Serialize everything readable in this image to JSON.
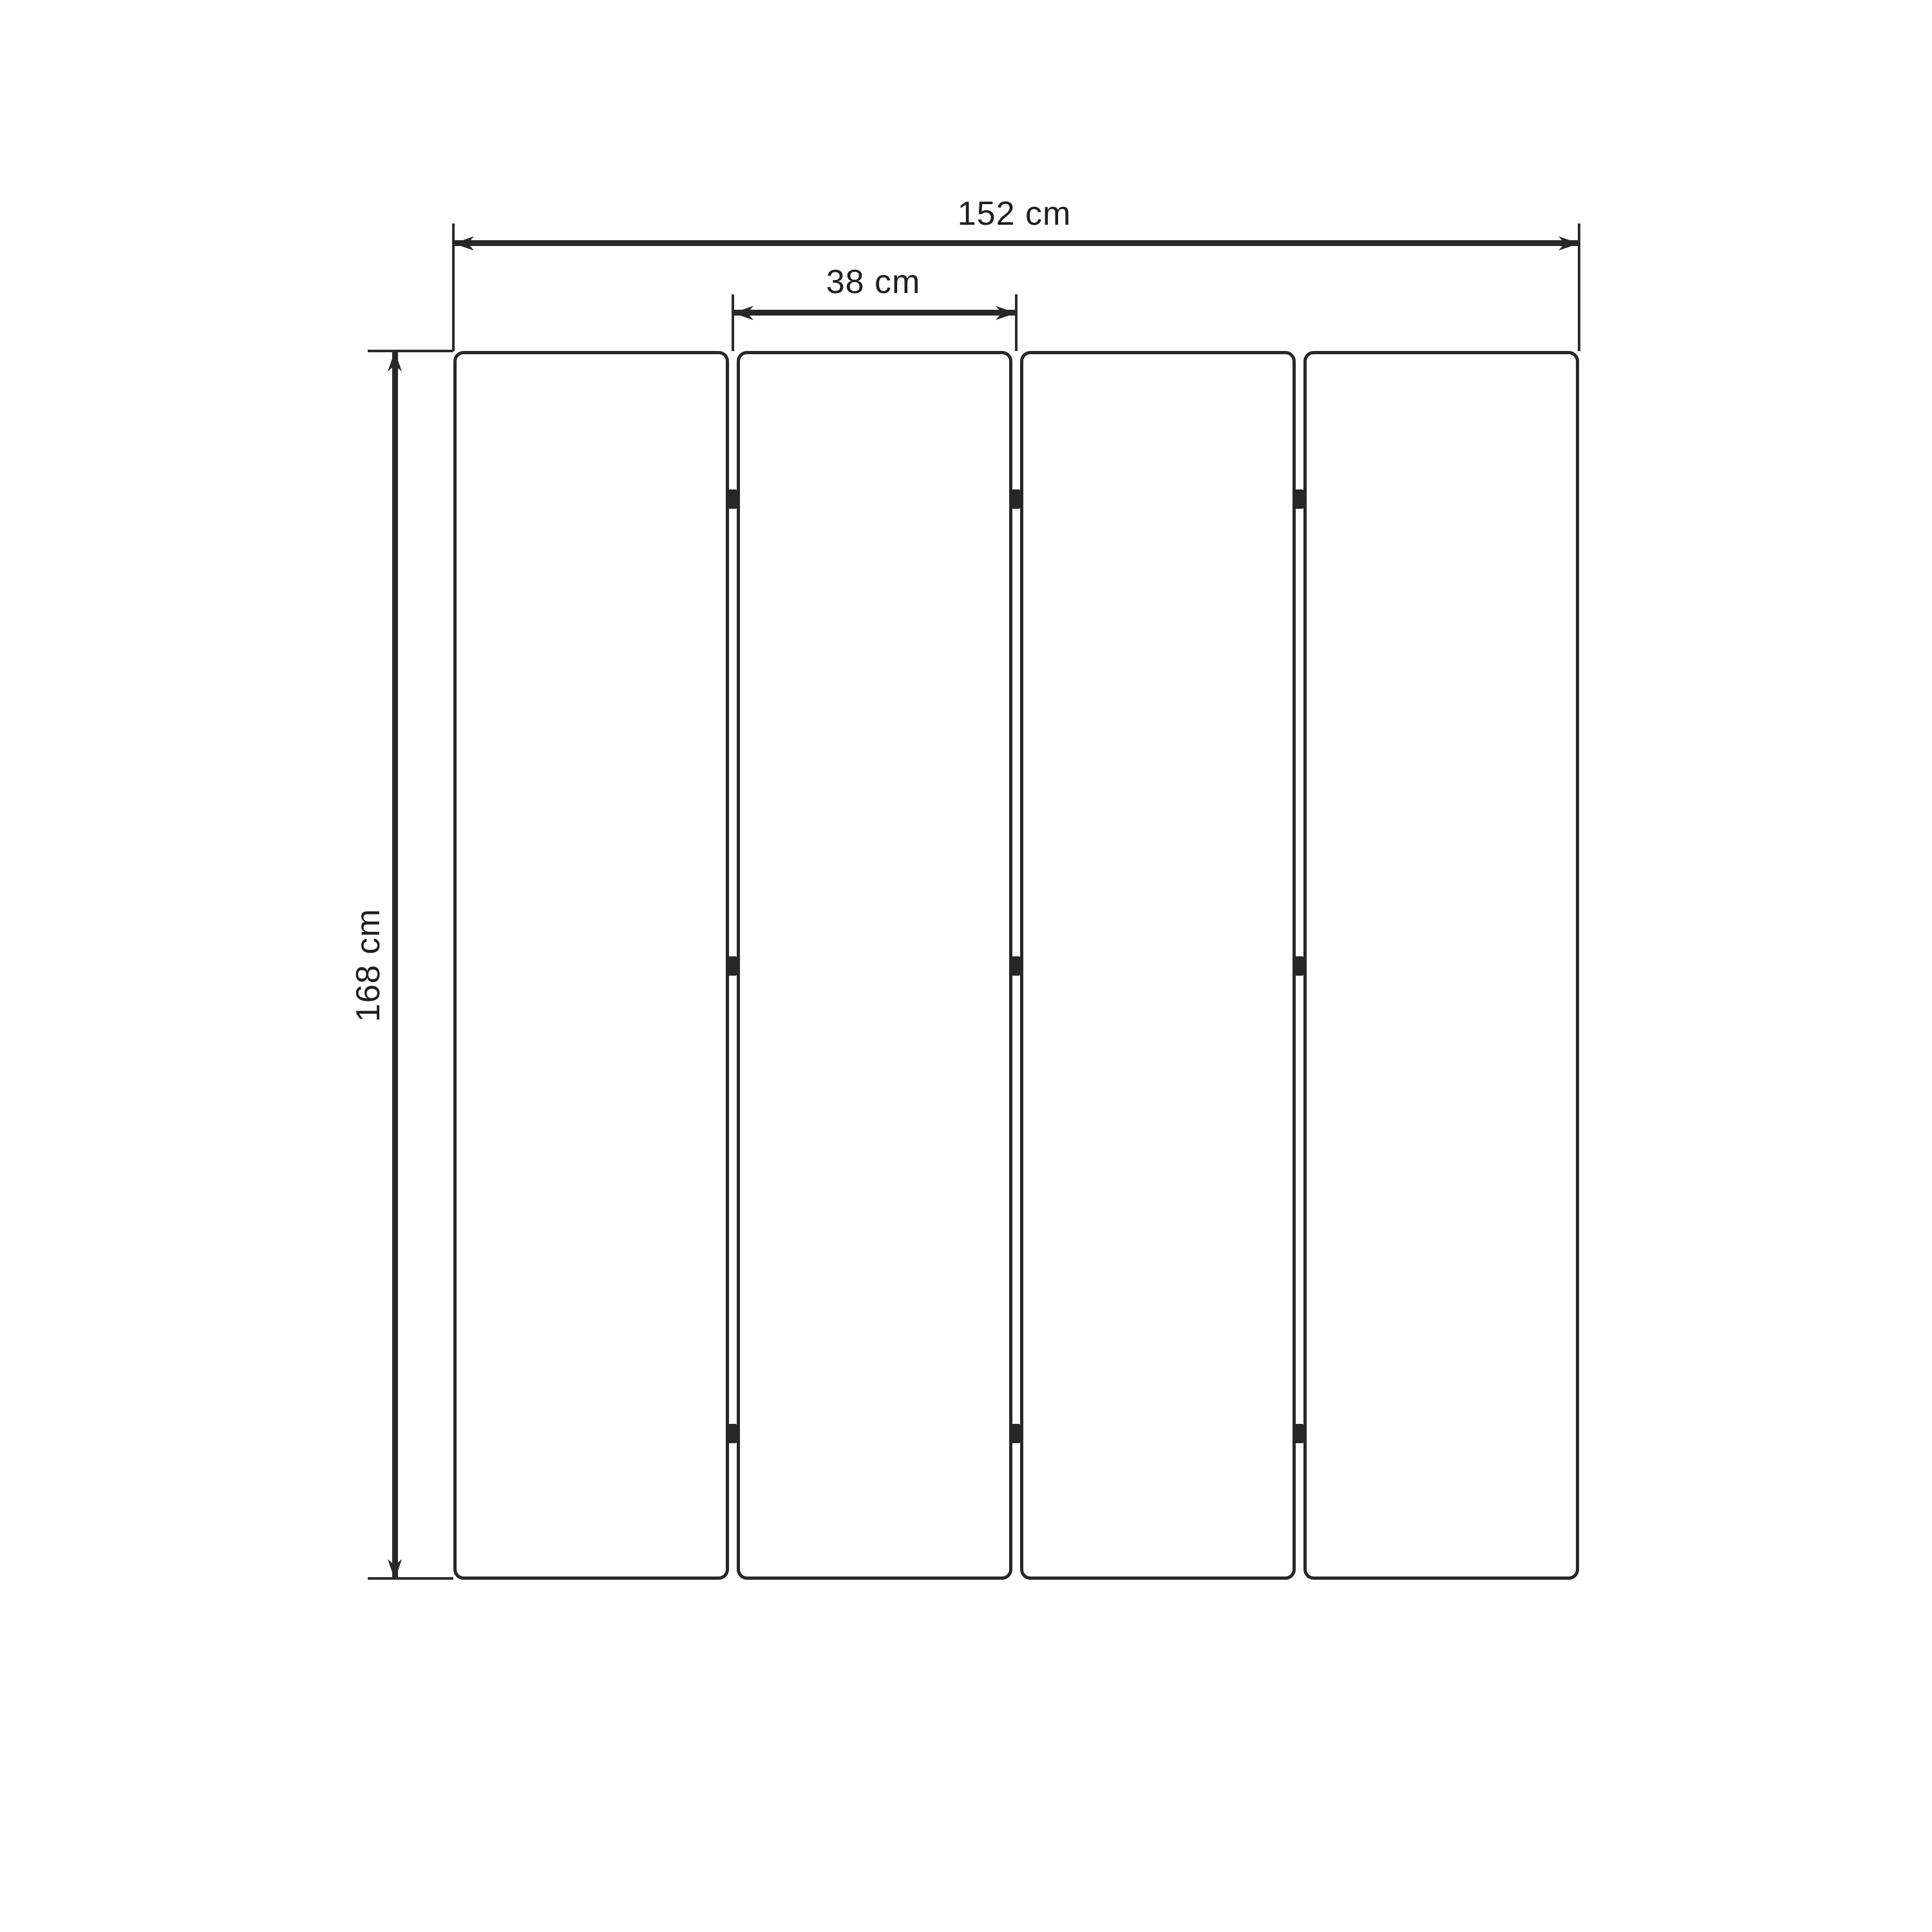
{
  "diagram": {
    "labels": {
      "total_width": "152 cm",
      "panel_width": "38 cm",
      "height": "168 cm"
    },
    "values": {
      "total_width_cm": 152,
      "panel_width_cm": 38,
      "height_cm": 168,
      "unit": "cm"
    },
    "panel_count": 4,
    "hinge_rows_per_gap": 3,
    "colors": {
      "line": "#272727",
      "background": "#ffffff"
    }
  }
}
